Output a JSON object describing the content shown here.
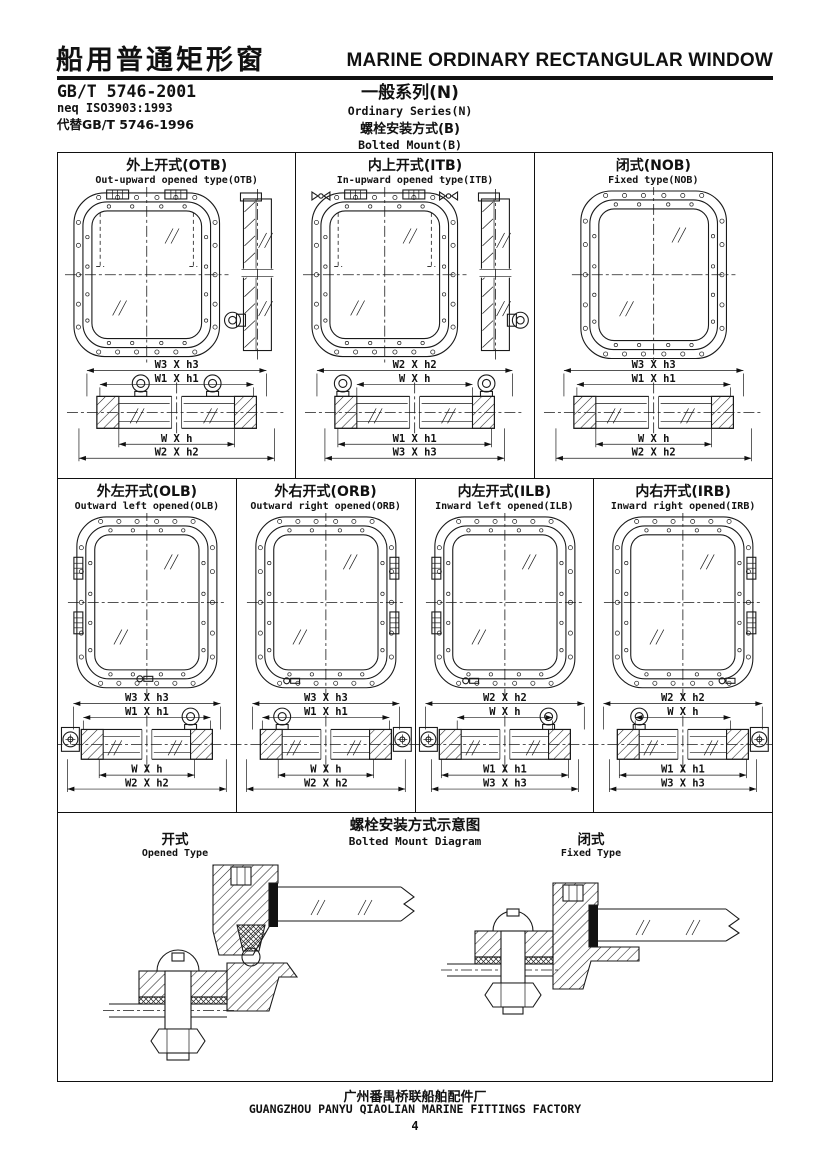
{
  "header": {
    "title_cn": "船用普通矩形窗",
    "title_en": "MARINE ORDINARY RECTANGULAR WINDOW",
    "standard": "GB/T 5746-2001",
    "standard_equiv": "neq ISO3903:1993",
    "standard_replaces": "代替GB/T 5746-1996",
    "series_cn": "一般系列(N)",
    "series_en": "Ordinary Series(N)",
    "mount_cn": "螺栓安装方式(B)",
    "mount_en": "Bolted Mount(B)"
  },
  "cells": [
    {
      "id": "OTB",
      "title_cn": "外上开式(OTB)",
      "title_en": "Out-upward opened type(OTB)",
      "dims": {
        "top": [
          "W3 X h3",
          "W1 X h1"
        ],
        "bottom": [
          "W X h",
          "W2 X h2"
        ]
      },
      "diagram": {
        "row": 1,
        "hinge": "top",
        "side_view": true,
        "eye": "left",
        "order": "out",
        "rings": [
          -36,
          36
        ],
        "knuckle": "",
        "wings": false,
        "handle": ""
      }
    },
    {
      "id": "ITB",
      "title_cn": "内上开式(ITB)",
      "title_en": "In-upward opened type(ITB)",
      "dims": {
        "top": [
          "W2 X h2",
          "W X h"
        ],
        "bottom": [
          "W1 X h1",
          "W3 X h3"
        ]
      },
      "diagram": {
        "row": 1,
        "hinge": "top",
        "side_view": true,
        "eye": "right",
        "order": "in",
        "rings": [
          -72,
          72
        ],
        "knuckle": "",
        "wings": true,
        "handle": ""
      }
    },
    {
      "id": "NOB",
      "title_cn": "闭式(NOB)",
      "title_en": "Fixed type(NOB)",
      "dims": {
        "top": [
          "W3 X h3",
          "W1 X h1"
        ],
        "bottom": [
          "W X h",
          "W2 X h2"
        ]
      },
      "diagram": {
        "row": 1,
        "hinge": "none",
        "side_view": false,
        "eye": "",
        "order": "out",
        "rings": [],
        "knuckle": "",
        "wings": false,
        "handle": ""
      }
    },
    {
      "id": "OLB",
      "title_cn": "外左开式(OLB)",
      "title_en": "Outward left opened(OLB)",
      "dims": {
        "top": [
          "W3 X h3",
          "W1 X h1"
        ],
        "bottom": [
          "W X h",
          "W2 X h2"
        ]
      },
      "diagram": {
        "row": 2,
        "hinge": "left",
        "side_view": false,
        "eye": "",
        "order": "out",
        "rings": [
          44
        ],
        "knuckle": "left",
        "wings": false,
        "handle": "bc"
      }
    },
    {
      "id": "ORB",
      "title_cn": "外右开式(ORB)",
      "title_en": "Outward right opened(ORB)",
      "dims": {
        "top": [
          "W3 X h3",
          "W1 X h1"
        ],
        "bottom": [
          "W X h",
          "W2 X h2"
        ]
      },
      "diagram": {
        "row": 2,
        "hinge": "right",
        "side_view": false,
        "eye": "",
        "order": "out",
        "rings": [
          -44
        ],
        "knuckle": "right",
        "wings": false,
        "handle": "bl"
      }
    },
    {
      "id": "ILB",
      "title_cn": "内左开式(ILB)",
      "title_en": "Inward left opened(ILB)",
      "dims": {
        "top": [
          "W2 X h2",
          "W X h"
        ],
        "bottom": [
          "W1 X h1",
          "W3 X h3"
        ]
      },
      "diagram": {
        "row": 2,
        "hinge": "left",
        "side_view": false,
        "eye": "",
        "order": "in",
        "rings": [
          44
        ],
        "knuckle": "left",
        "wings": false,
        "handle": "bl"
      }
    },
    {
      "id": "IRB",
      "title_cn": "内右开式(IRB)",
      "title_en": "Inward right opened(IRB)",
      "dims": {
        "top": [
          "W2 X h2",
          "W X h"
        ],
        "bottom": [
          "W1 X h1",
          "W3 X h3"
        ]
      },
      "diagram": {
        "row": 2,
        "hinge": "right",
        "side_view": false,
        "eye": "",
        "order": "in",
        "rings": [
          -44
        ],
        "knuckle": "right",
        "wings": false,
        "handle": "br"
      }
    }
  ],
  "mount_section": {
    "title_cn": "螺栓安装方式示意图",
    "title_en": "Bolted Mount Diagram",
    "opened_cn": "开式",
    "opened_en": "Opened Type",
    "fixed_cn": "闭式",
    "fixed_en": "Fixed Type"
  },
  "footer": {
    "factory_cn": "广州番禺桥联船舶配件厂",
    "factory_en": "GUANGZHOU PANYU QIAOLIAN MARINE FITTINGS FACTORY",
    "page_number": "4"
  }
}
